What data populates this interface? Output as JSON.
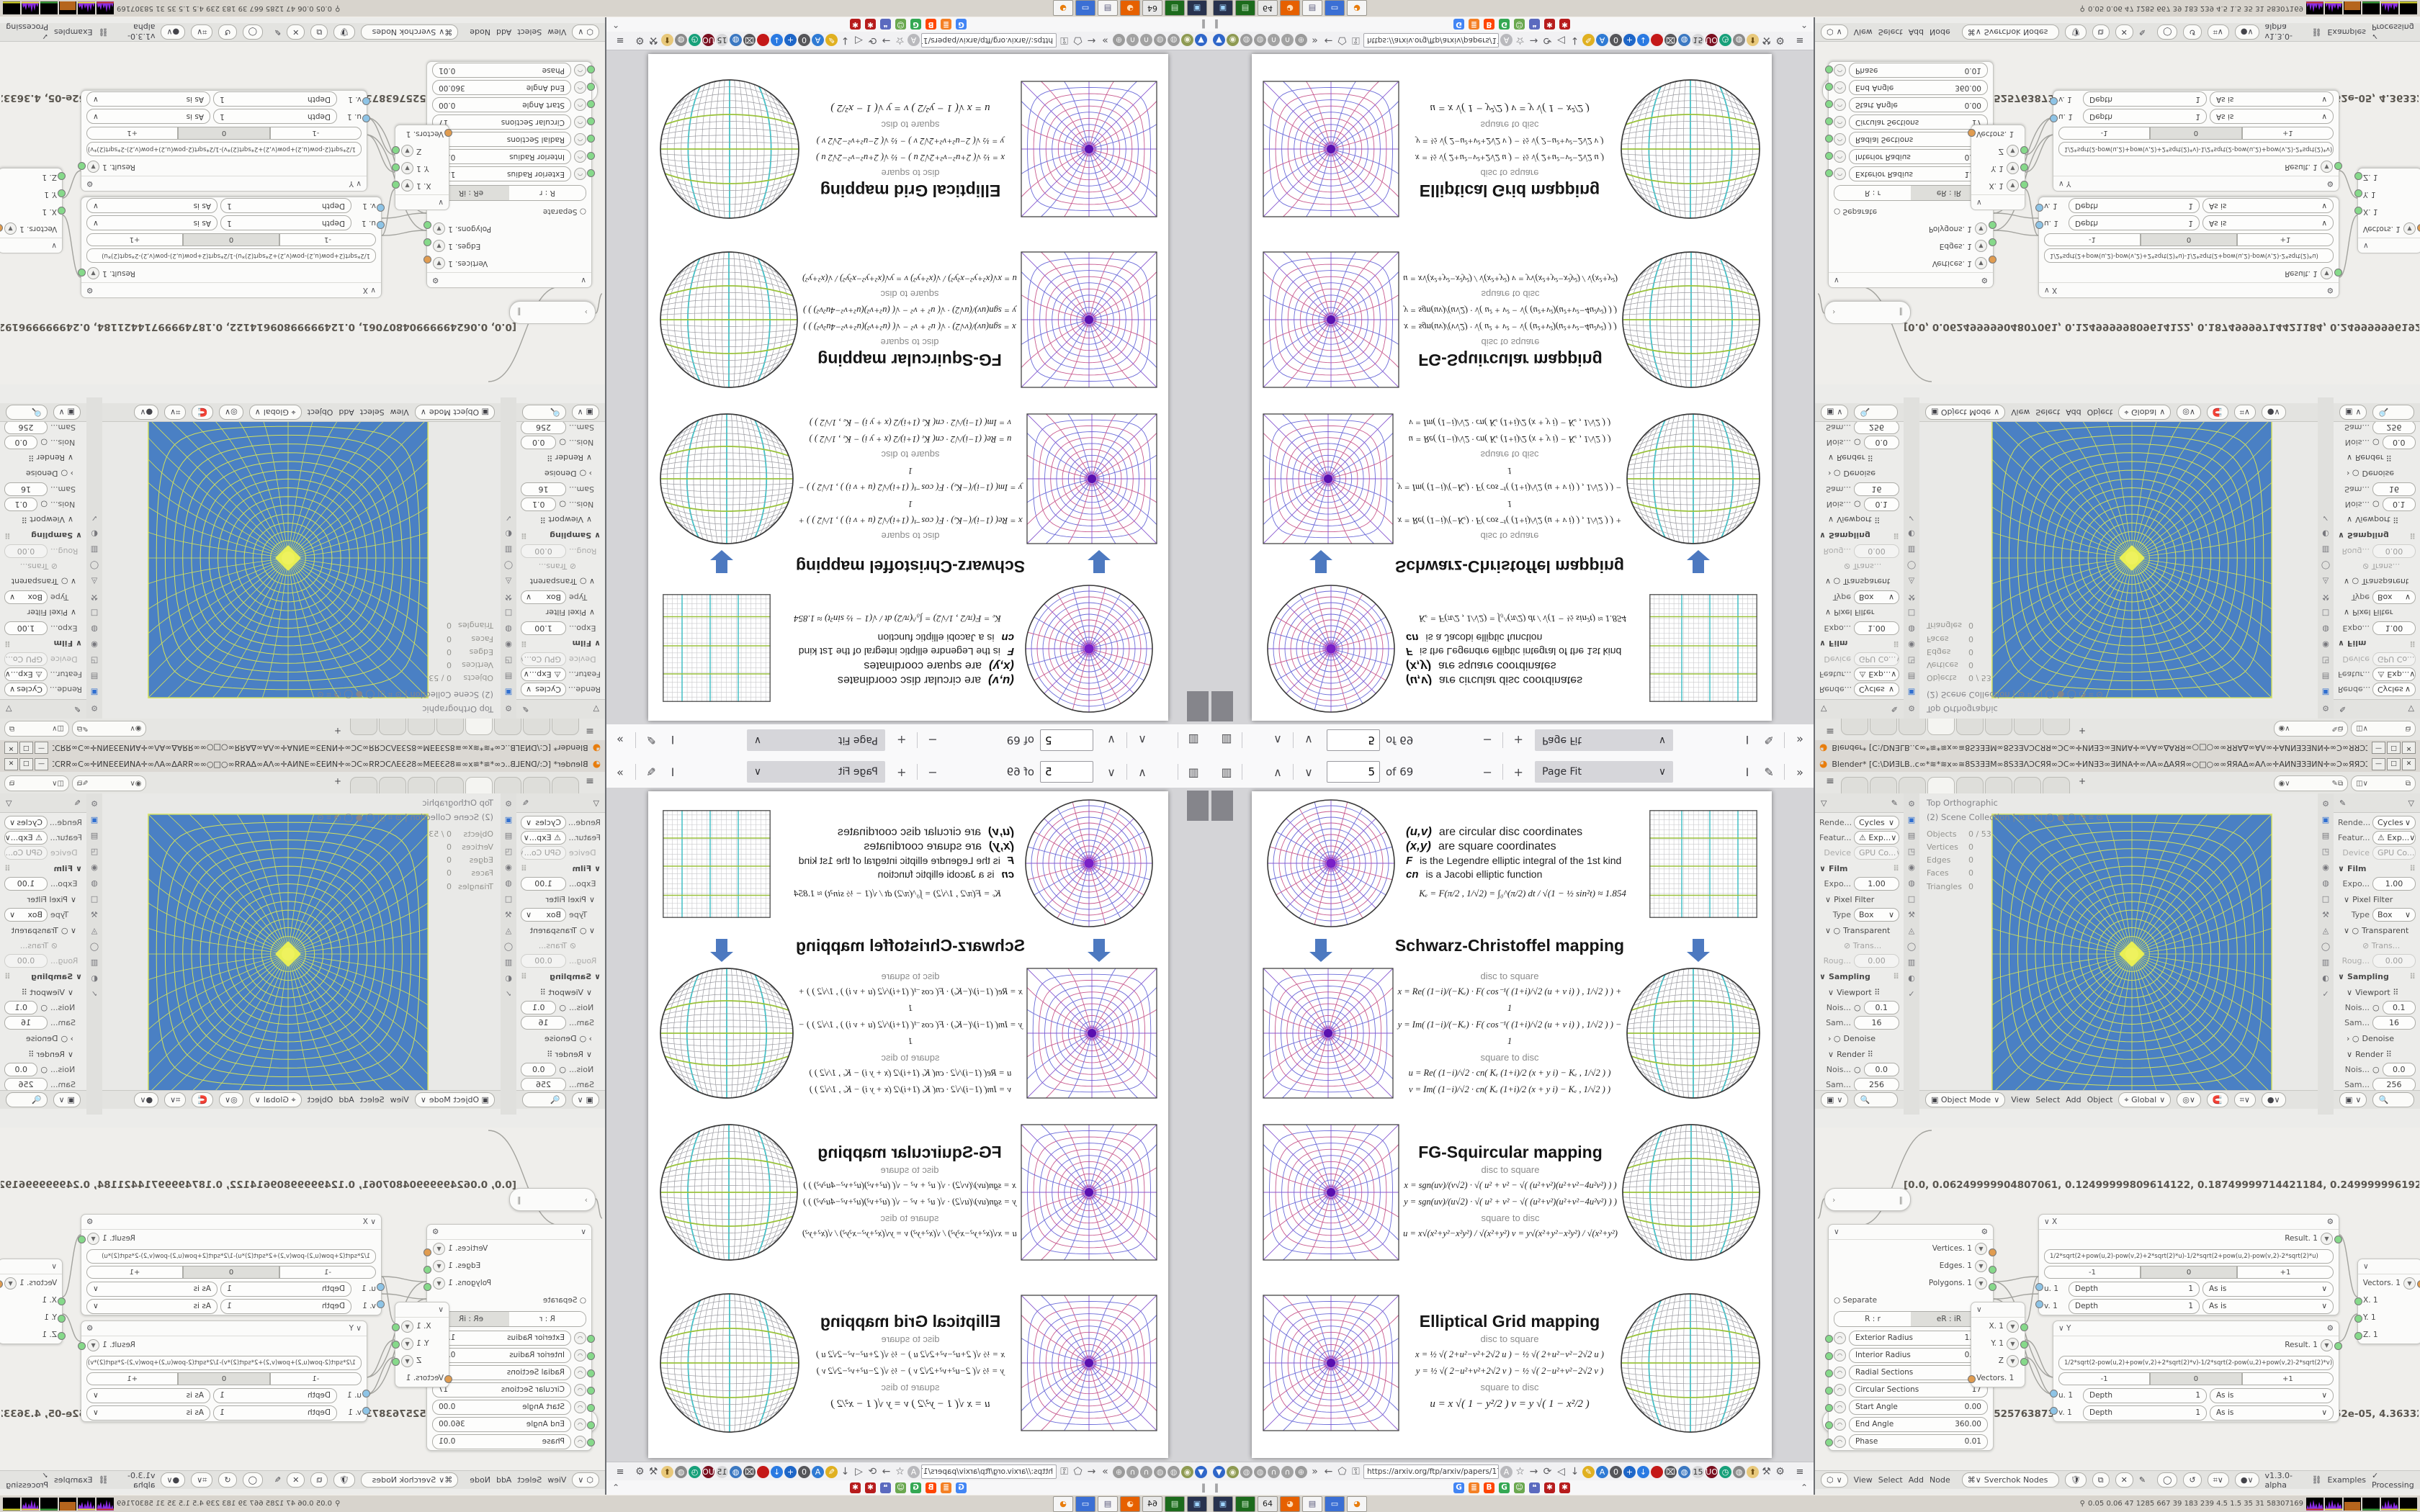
{
  "pdf": {
    "toolbar": {
      "page_value": "5",
      "of_label": "of 69",
      "zoom_value": "Page Fit",
      "minus": "−",
      "plus": "+",
      "up": "∧",
      "down": "∨",
      "more": "»",
      "text_tool": "I",
      "draw_tool": "✎",
      "sidebar": "▥"
    },
    "labels": {
      "disc_to_square": "disc to square",
      "square_to_disc": "square to disc"
    },
    "intro": {
      "lines": [
        {
          "head": "(u,v)",
          "rest": "are circular disc coordinates",
          "small": false
        },
        {
          "head": "(x,y)",
          "rest": "are square coordinates",
          "small": false
        },
        {
          "head": "F",
          "rest": "is the Legendre elliptic integral of the 1st kind",
          "small": true
        },
        {
          "head": "cn",
          "rest": "is a Jacobi elliptic function",
          "small": true
        }
      ],
      "ke_formula": "Kₑ =  F(π/2 , 1/√2) = ∫₀^(π/2)  dt / √(1 − ½ sin²t)   ≈ 1.854"
    },
    "sections": [
      {
        "title": "Schwarz-Christoffel mapping",
        "d2s": [
          "x = Re( (1−i)/(−Kₑ) · F( cos⁻¹( (1+i)/√2 (u + v i) ) , 1/√2 ) ) + 1",
          "y = Im( (1−i)/(−Kₑ) · F( cos⁻¹( (1+i)/√2 (u + v i) ) , 1/√2 ) ) − 1"
        ],
        "s2d": [
          "u = Re( (1−i)/√2 · cn( Kₑ (1+i)/2 (x + y i) − Kₑ , 1/√2 ) )",
          "v = Im( (1−i)/√2 · cn( Kₑ (1+i)/2 (x + y i) − Kₑ , 1/√2 ) )"
        ]
      },
      {
        "title": "FG-Squircular mapping",
        "d2s": [
          "x = sgn(uv)/(v√2) · √( u² + v² − √( (u²+v²)(u²+v²−4u²v²) ) )",
          "y = sgn(uv)/(u√2) · √( u² + v² − √( (u²+v²)(u²+v²−4u²v²) ) )"
        ],
        "s2d": [
          "u = x√(x²+y²−x²y²) / √(x²+y²)        v = y√(x²+y²−x²y²) / √(x²+y²)"
        ]
      },
      {
        "title": "Elliptical Grid mapping",
        "d2s": [
          "x = ½ √( 2+u²−v²+2√2 u )  −  ½ √( 2+u²−v²−2√2 u )",
          "y = ½ √( 2−u²+v²+2√2 v )  −  ½ √( 2−u²+v²−2√2 v )"
        ],
        "s2d": [
          "u = x √( 1 − y²/2 )            v = y √( 1 − x²/2 )"
        ]
      }
    ]
  },
  "browser": {
    "url": "https://arxiv.org/ftp/arxiv/papers/1709/1709",
    "nav_icons_left": [
      {
        "name": "location-pin-icon",
        "glyph": "▼",
        "bg": "#2f66c9",
        "fg": "#fff"
      },
      {
        "name": "profile-icon",
        "glyph": "◉",
        "bg": "#8e9a52",
        "fg": "#f2f2e0"
      },
      {
        "name": "globe-icon",
        "glyph": "◍",
        "bg": "#9b9b9b",
        "fg": "#eee"
      },
      {
        "name": "globe-icon",
        "glyph": "◍",
        "bg": "#9b9b9b",
        "fg": "#eee"
      },
      {
        "name": "headset-icon",
        "glyph": "∩",
        "bg": "#a2a2a2",
        "fg": "#fff"
      },
      {
        "name": "headset-icon",
        "glyph": "∩",
        "bg": "#a2a2a2",
        "fg": "#fff"
      },
      {
        "name": "globe-icon",
        "glyph": "⊕",
        "bg": "#9b9b9b",
        "fg": "#eee"
      },
      {
        "name": "overflow-chevrons-icon",
        "glyph": "»",
        "bg": "",
        "fg": ""
      },
      {
        "name": "back-icon",
        "glyph": "←",
        "bg": "",
        "fg": ""
      },
      {
        "name": "shield-icon",
        "glyph": "⬠",
        "bg": "",
        "fg": ""
      },
      {
        "name": "lock-icon",
        "glyph": "⚿",
        "bg": "",
        "fg": ""
      }
    ],
    "nav_icons_right": [
      {
        "name": "translate-icon",
        "glyph": "A",
        "bg": "#b9b9bd",
        "fg": "#fff"
      },
      {
        "name": "star-icon",
        "glyph": "☆",
        "bg": "",
        "fg": ""
      },
      {
        "name": "forward-icon",
        "glyph": "→",
        "bg": "",
        "fg": ""
      },
      {
        "name": "reload-icon",
        "glyph": "⟳",
        "bg": "",
        "fg": ""
      },
      {
        "name": "speaker-icon",
        "glyph": "◁",
        "bg": "",
        "fg": ""
      },
      {
        "name": "download-icon",
        "glyph": "↓",
        "bg": "",
        "fg": ""
      },
      {
        "name": "marker-icon",
        "glyph": "✎",
        "bg": "#e0b020",
        "fg": "#fff"
      },
      {
        "name": "translate-blue-icon",
        "glyph": "A",
        "bg": "#2f7ad4",
        "fg": "#fff"
      },
      {
        "name": "zero-badge-icon",
        "glyph": "0",
        "bg": "#56565a",
        "fg": "#fff"
      },
      {
        "name": "add-circle-icon",
        "glyph": "+",
        "bg": "#1e66c8",
        "fg": "#fff"
      },
      {
        "name": "down-circle-icon",
        "glyph": "↓",
        "bg": "#2a7ae2",
        "fg": "#fff"
      },
      {
        "name": "record-circle-icon",
        "glyph": "●",
        "bg": "#c41818",
        "fg": "#c41818"
      },
      {
        "name": "trash-icon",
        "glyph": "⌧",
        "bg": "#5a5a5e",
        "fg": "#fff"
      },
      {
        "name": "globe-blue-icon",
        "glyph": "◍",
        "bg": "#3b78c2",
        "fg": "#fff"
      },
      {
        "name": "pages-badge-icon",
        "glyph": "15",
        "bg": "#d8d8da",
        "fg": "#333"
      },
      {
        "name": "uo-badge-icon",
        "glyph": "UO",
        "bg": "#7a1020",
        "fg": "#fff"
      },
      {
        "name": "clock-icon",
        "glyph": "◷",
        "bg": "#17a07a",
        "fg": "#fff"
      },
      {
        "name": "globe-gray-icon",
        "glyph": "◍",
        "bg": "#8a8a8a",
        "fg": "#fff"
      },
      {
        "name": "thumb-icon",
        "glyph": "⬆",
        "bg": "#e8c87a",
        "fg": "#6a4a10"
      },
      {
        "name": "wrench-icon",
        "glyph": "⚒",
        "bg": "",
        "fg": ""
      },
      {
        "name": "gear-icon",
        "glyph": "⚙",
        "bg": "",
        "fg": ""
      }
    ],
    "menu_icon": "≡",
    "bookmark_icons": [
      {
        "name": "google-favicon",
        "glyph": "G",
        "bg": "#4285f4"
      },
      {
        "name": "stackoverflow-favicon",
        "glyph": "≣",
        "bg": "#f48024"
      },
      {
        "name": "reddit-favicon",
        "glyph": "B",
        "bg": "#ff4500"
      },
      {
        "name": "google-green-favicon",
        "glyph": "G",
        "bg": "#34a853"
      },
      {
        "name": "smiley-favicon",
        "glyph": "☺",
        "bg": "#6aa84f"
      },
      {
        "name": "chat-favicon",
        "glyph": "❝",
        "bg": "#5b6abf"
      },
      {
        "name": "gear-red-favicon",
        "glyph": "✱",
        "bg": "#b71c1c"
      },
      {
        "name": "gear-red-favicon",
        "glyph": "✱",
        "bg": "#b71c1c"
      }
    ],
    "pause_glyph": "‖",
    "collapse_glyph": "⌃"
  },
  "taskbar": {
    "apps": [
      {
        "name": "terminal-app-icon",
        "glyph": "▣",
        "bg": "#28324e",
        "fg": "#9fd4ff"
      },
      {
        "name": "book-app-icon",
        "glyph": "▤",
        "bg": "#1c6b1c",
        "fg": "#d8f0d8"
      },
      {
        "name": "floppy64-app-icon",
        "glyph": "64",
        "bg": "#e8e8e8",
        "fg": "#222"
      },
      {
        "name": "firefox-app-icon",
        "glyph": "◕",
        "bg": "#e66000",
        "fg": "#ffd9b0"
      },
      {
        "name": "notepad-app-icon",
        "glyph": "▤",
        "bg": "#f5f5f5",
        "fg": "#557"
      },
      {
        "name": "window-app-icon",
        "glyph": "▭",
        "bg": "#3b6fd4",
        "fg": "#fff"
      },
      {
        "name": "blender-app-icon",
        "glyph": "◕",
        "bg": "#f5f5f5",
        "fg": "#e87d0d"
      }
    ],
    "tray_text": "0.05 0.06   47   1285 667   39   183 239   4.5   1.5   35   31   58307169",
    "tray_person": "⚲"
  },
  "blender": {
    "title": "Blender* [C:\\DИƎLB..c∞*≋*≋x∞≅8S3ƎƎM∞8S3ƎΛƆCЯЯ∞ƆC∞✛ИNƎЗ∞ƎИNA✛∞ΛA∞ΔAЯЯ∞○□○∞∞ЯЯAΔ∞AΛ∞✛AИNƎЗƎИN✛∞Ɔ∞ЯЯƆƆΛ3Ǝ2S∞M3Ǝ2S≅∞≋*∞*≋∞..",
    "window_buttons": [
      "—",
      "□",
      "✕"
    ],
    "topbar": {
      "menu_icon": "≡",
      "tab_count": 8,
      "active_tab": 3,
      "plus": "+"
    },
    "props": {
      "funnel_icon": "▽",
      "pin_icon": "✎",
      "rows": [
        {
          "t": "select",
          "label": "Rende...",
          "value": "Cycles"
        },
        {
          "t": "select",
          "label": "Featur...",
          "value": "⚠ Exp..."
        },
        {
          "t": "select",
          "label": "Device",
          "value": "GPU Co...",
          "dim": 1
        },
        {
          "t": "section",
          "label": "Film"
        },
        {
          "t": "field",
          "label": "Expo...",
          "value": "1.00"
        },
        {
          "t": "sub",
          "label": "Pixel Filter"
        },
        {
          "t": "select",
          "label": "Type",
          "value": "Box"
        },
        {
          "t": "subcheck",
          "label": "Transparent"
        },
        {
          "t": "checkdim",
          "label": "⊘ Trans..."
        },
        {
          "t": "field",
          "label": "Roug...",
          "value": "0.00",
          "dim": 1
        },
        {
          "t": "section",
          "label": "Sampling"
        },
        {
          "t": "sub2",
          "label": "Viewport ⠿"
        },
        {
          "t": "dotfield",
          "label": "Nois...",
          "value": "0.1"
        },
        {
          "t": "field",
          "label": "Sam...",
          "value": "16"
        },
        {
          "t": "subarrow",
          "label": "Denoise"
        },
        {
          "t": "sub2",
          "label": "Render ⠿"
        },
        {
          "t": "dotfield",
          "label": "Nois...",
          "value": "0.0"
        },
        {
          "t": "field",
          "label": "Sam...",
          "value": "256"
        },
        {
          "t": "field",
          "label": "Time...",
          "value": "0 sec"
        }
      ],
      "tab_icons": [
        "⚙",
        "▣",
        "▤",
        "◳",
        "◉",
        "◍",
        "□",
        "⚒",
        "◬",
        "◯",
        "▥",
        "◐",
        "✓"
      ]
    },
    "viewport": {
      "view_label": "Top Orthographic",
      "collection_label": "(2) Scene Collection |  ⊙ ⌗ ◫ ◯ ● ◯ ◔ ⌗ ⊙",
      "stats": [
        [
          "Objects",
          "0 / 53"
        ],
        [
          "Vertices",
          "0"
        ],
        [
          "Edges",
          "0"
        ],
        [
          "Faces",
          "0"
        ],
        [
          "Triangles",
          "0"
        ]
      ],
      "header": {
        "mode": "Object Mode",
        "menus": [
          "View",
          "Select",
          "Add",
          "Object"
        ],
        "orientation": "Global"
      }
    },
    "node_editor": {
      "steth1": "[0.0, 0.06249999904807061, 0.12499999809614122, 0.18749999714421184, 0.24999999619228244, 0.31249999524035305, 0.374",
      "steth2": "[0.0, 1.0908307525763873e-05, 2.1816615051527747e-05, 3.272492257729162e-05, 4.363323010305549e-05, 5.454153762881936",
      "circle_node": {
        "outputs": [
          [
            "Vertices. 1",
            "so"
          ],
          [
            "Edges. 1",
            "sg"
          ],
          [
            "Polygons. 1",
            "sg"
          ]
        ],
        "separate_label": "Separate",
        "tabs": [
          "R : r",
          "eR : iR"
        ],
        "params": [
          [
            "Exterior Radius",
            "1.00"
          ],
          [
            "Interior Radius",
            "0.00"
          ],
          [
            "Radial Sections",
            "64"
          ],
          [
            "Circular Sections",
            "17"
          ],
          [
            "Start Angle",
            "0.00"
          ],
          [
            "End Angle",
            "360.00"
          ],
          [
            "Phase",
            "0.01"
          ]
        ]
      },
      "vector_out": {
        "rows": [
          "X. 1",
          "Y. 1",
          "Z"
        ],
        "bottom": "Vectors. 1"
      },
      "x_node": {
        "label": "X",
        "result": "Result. 1",
        "formula": "1/2*sqrt(2+pow(u,2)-pow(v,2)+2*sqrt(2)*u)-1/2*sqrt(2+pow(u,2)-pow(v,2)-2*sqrt(2)*u)",
        "seg": [
          "-1",
          "0",
          "+1"
        ],
        "depth": [
          "Depth",
          "1",
          "As is"
        ],
        "inputs": [
          "u. 1",
          "v. 1"
        ],
        "wrench": "⚙"
      },
      "y_node": {
        "label": "Y",
        "result": "Result. 1",
        "formula": "1/2*sqrt(2-pow(u,2)+pow(v,2)+2*sqrt(2)*v)-1/2*sqrt(2-pow(u,2)+pow(v,2)-2*sqrt(2)*v)",
        "seg": [
          "-1",
          "0",
          "+1"
        ],
        "depth": [
          "Depth",
          "1",
          "As is"
        ],
        "inputs": [
          "u. 1",
          "v. 1"
        ],
        "wrench": "⚙"
      },
      "vector_in": {
        "top": "Vectors. 1",
        "rows": [
          "X. 1",
          "Y. 1",
          "Z. 1"
        ]
      },
      "header": {
        "menus": [
          "View",
          "Select",
          "Add",
          "Node"
        ],
        "tree_name": "Sverchok Nodes",
        "version": "v1.3.0-alpha",
        "examples": "Examples",
        "processing": "Processing",
        "check": "✓"
      }
    }
  },
  "figure_palette": {
    "ring_colors": [
      "#6b6bd8",
      "#c85a8e"
    ],
    "spoke_colors": [
      "#8a5ad0",
      "#c85a8e",
      "#6b6bd8"
    ],
    "center": "#7a20c8",
    "grid_gray": "#9a9aa0",
    "fine_gray": "#c9c9cc",
    "cyan": "#45c1c7",
    "green": "#9ac23c",
    "outline": "#3a3a3a",
    "viewport_bg": "#4a80c4",
    "viewport_line": "#d2e05c",
    "viewport_center": "#e8ef55"
  }
}
